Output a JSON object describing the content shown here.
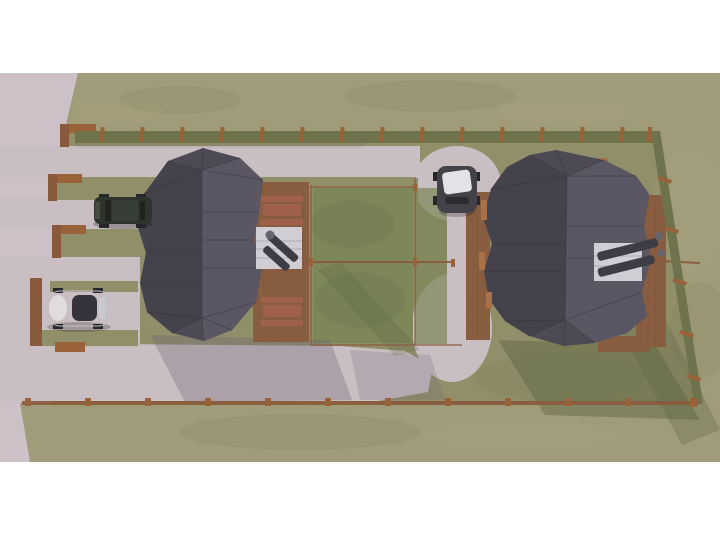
{
  "scene": {
    "type": "3d-architectural-render",
    "view": "aerial-top-down",
    "description": "Top-down 3D visualization of two cabins with dark faceted hip roofs on a long fenced grass plot; wooden decks with picnic tables and white flue units, gravel parking bays and curved paths, a paved road on the left, and three parked cars.",
    "objects": {
      "left_house": "cabin with dark hip roof and side deck",
      "right_house": "cabin with dark hip roof and rear deck",
      "left_deck_furniture": "two picnic table sets and white flue unit with dark pipes",
      "right_flue_unit": "white unit with two dark pipes toward fence",
      "suv": "dark green SUV parked in upper-left bay",
      "white_car": "white hatchback parked in lower-left bay",
      "gray_car": "dark gray car with white roof on gravel path",
      "perimeter_fence": "wooden posts with low hedge rows and rails",
      "garden_squares": "fenced grass garden squares between the houses",
      "gravel_paths": "gravel lanes, curved footpaths and bottom drive",
      "road": "paved road area on the left edge"
    }
  },
  "palette": {
    "white_bg": "#ffffff",
    "pavement": "#d7cacf",
    "pavement_path": "#d3c7ca",
    "grass_outer": "#a49f76",
    "grass_plot": "#939165",
    "grass_garden": "#7c8852",
    "grass_dark": "#5f6b3e",
    "grass_light": "#bab287",
    "hedge": "#6b7243",
    "fence_wood": "#9c5e2d",
    "rail_wood": "#8a5430",
    "deck_wood": "#8a5a36",
    "table_wood": "#a35d40",
    "roof_base": "#46434e",
    "roof_light": "#555260",
    "roof_dark": "#3a3741",
    "trim_orange": "#b06e3e",
    "white_box": "#d9d9e0",
    "chimney_dark": "#33333b",
    "chimney_cap": "#62626c",
    "suv_body": "#222a20",
    "suv_roof": "#2c352b",
    "suv_window": "#11150f",
    "car_white_body": "#ebebef",
    "car_white_glass": "#2a2a32",
    "car_dark_body": "#3b3a40",
    "car_dark_roof": "#f0f0f4",
    "wheel": "#1a1a1e",
    "shadow_cool": "#6b5c74",
    "shadow_warm": "#4e5a33"
  }
}
